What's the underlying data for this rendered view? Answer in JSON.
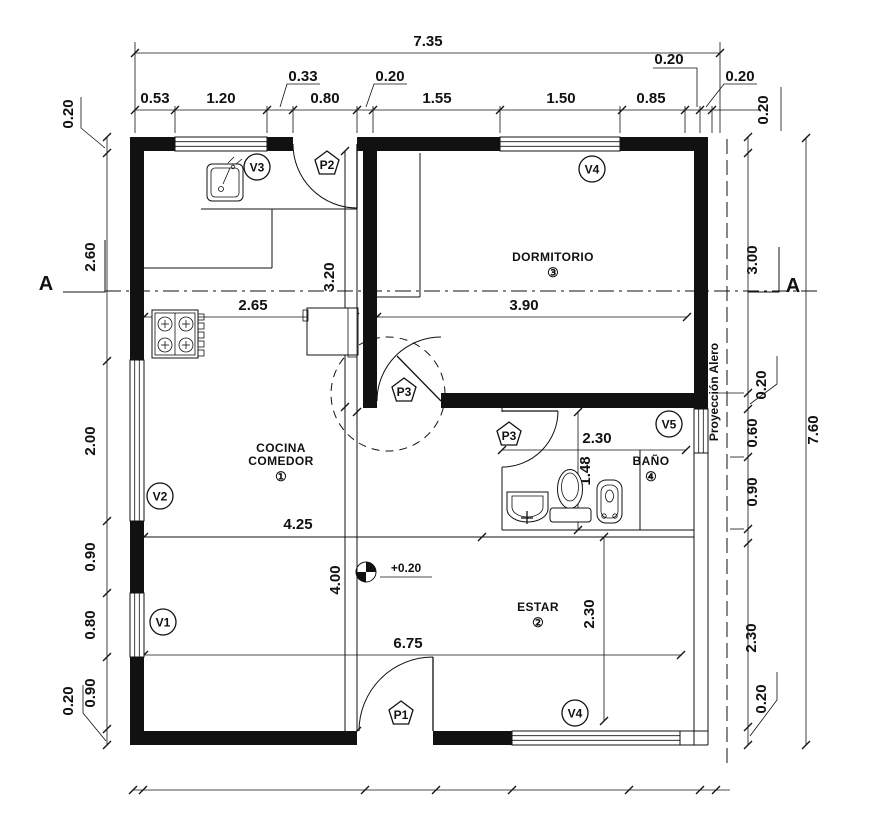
{
  "colors": {
    "ink": "#111111",
    "bg": "#ffffff"
  },
  "dims": {
    "overall_width": "7.35",
    "overall_height": "7.60",
    "top_labels": [
      "0.53",
      "1.20",
      "0.80",
      "1.55",
      "1.50",
      "0.85"
    ],
    "top_offsets": [
      "0.33",
      "0.20",
      "0.20",
      "0.20",
      "0.20"
    ],
    "left_labels": [
      "0.20",
      "2.60",
      "2.00",
      "0.90",
      "0.80",
      "0.90",
      "0.20"
    ],
    "right_labels": [
      "0.20",
      "3.00",
      "0.20",
      "0.60",
      "0.90",
      "2.30",
      "0.20"
    ],
    "interior": {
      "kitchen_width": "2.65",
      "bedroom_width": "3.90",
      "passage_height": "3.20",
      "kitchen_total_width": "4.25",
      "passage_depth": "4.00",
      "living_width": "6.75",
      "living_height": "2.30",
      "bath_width": "2.30",
      "bath_depth": "1.48"
    },
    "level_mark": "+0.20"
  },
  "rooms": {
    "kitchen": {
      "name_line1": "COCINA",
      "name_line2": "COMEDOR",
      "number": "①"
    },
    "living": {
      "name": "ESTAR",
      "number": "②"
    },
    "bedroom": {
      "name": "DORMITORIO",
      "number": "③"
    },
    "bath": {
      "name": "BAÑO",
      "number": "④"
    }
  },
  "windows": {
    "v1": "V1",
    "v2": "V2",
    "v3": "V3",
    "v4_top": "V4",
    "v4_bottom": "V4",
    "v5": "V5"
  },
  "doors": {
    "p1": "P1",
    "p2": "P2",
    "p3_bedroom": "P3",
    "p3_bath": "P3"
  },
  "section": {
    "label_left": "A",
    "label_right": "A"
  },
  "eave": {
    "label": "Proyección Alero"
  }
}
